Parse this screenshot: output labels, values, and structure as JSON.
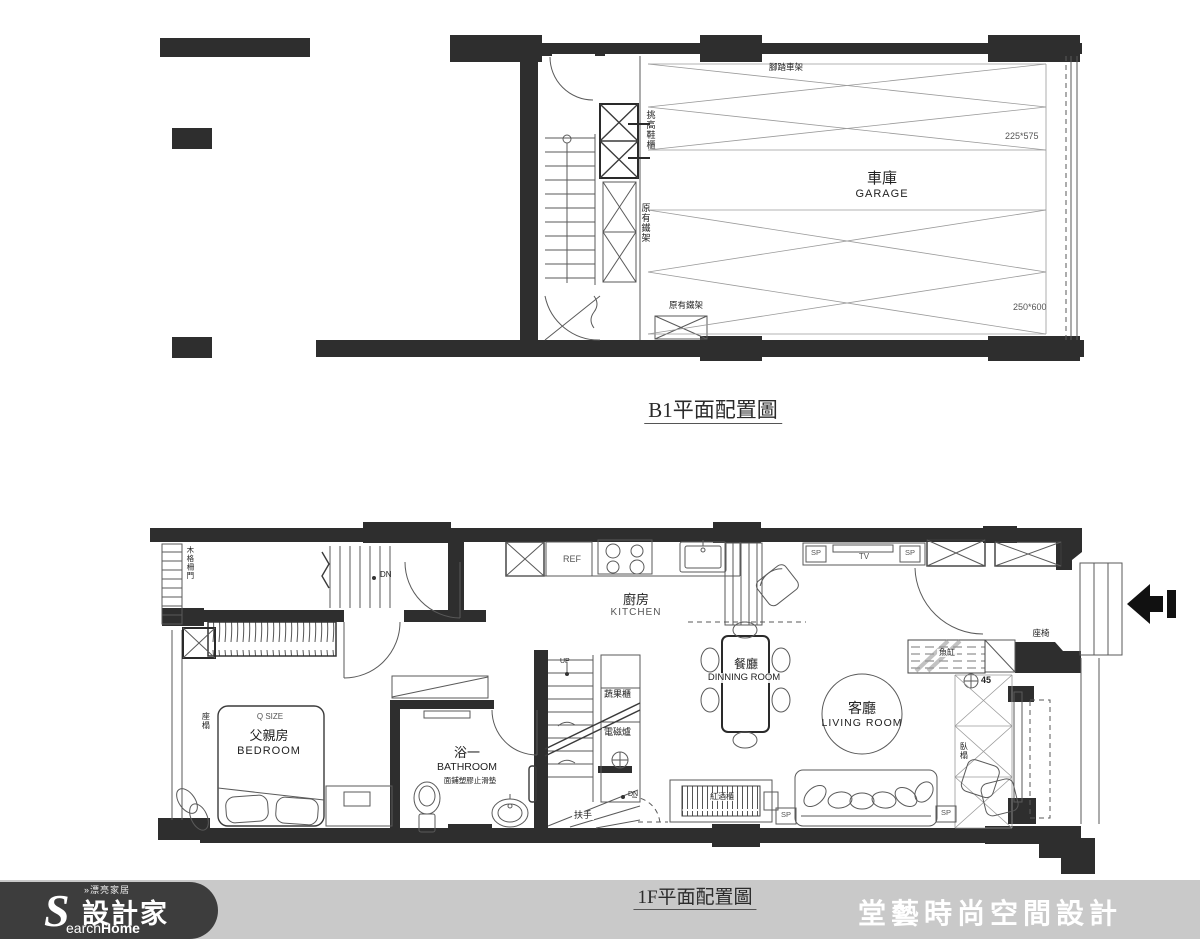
{
  "b1": {
    "title": "B1平面配置圖",
    "labels": {
      "bike_rack": "腳踏車架",
      "dim_upper": "225*575",
      "dim_lower": "250*600",
      "garage_zh": "車庫",
      "garage_en": "GARAGE",
      "shoe_cabinet": "挑高鞋櫃",
      "iron_rack": "原有鐵架"
    }
  },
  "f1": {
    "title": "1F平面配置圖",
    "rooms": {
      "kitchen_zh": "廚房",
      "kitchen_en": "KITCHEN",
      "dining_zh": "餐廳",
      "dining_en": "DINNING ROOM",
      "living_zh": "客廳",
      "living_en": "LIVING ROOM",
      "bath_zh": "浴一",
      "bath_en": "BATHROOM",
      "bath_note": "面鋪塑膠止滑墊",
      "bedroom_zh": "父親房",
      "bedroom_en": "BEDROOM"
    },
    "labels": {
      "dn": "DN",
      "up": "UP",
      "ref": "REF",
      "tv": "TV",
      "sp": "SP",
      "q_size": "Q SIZE",
      "seat_platform": "座榻",
      "wood_door": "木格柵門",
      "veg_cabinet": "蔬果櫃",
      "induction": "電磁爐",
      "handrail": "扶手",
      "fish_tank": "魚缸",
      "seat": "座椅",
      "num45": "45",
      "daybed": "臥榻",
      "wine_cabinet": "紅酒櫃"
    }
  },
  "footer": {
    "brand_small": "»漂亮家居",
    "brand_zh": "設計家",
    "brand_s": "S",
    "brand_earch": "earch",
    "brand_home": "Home",
    "company": "堂藝時尚空間設計"
  }
}
